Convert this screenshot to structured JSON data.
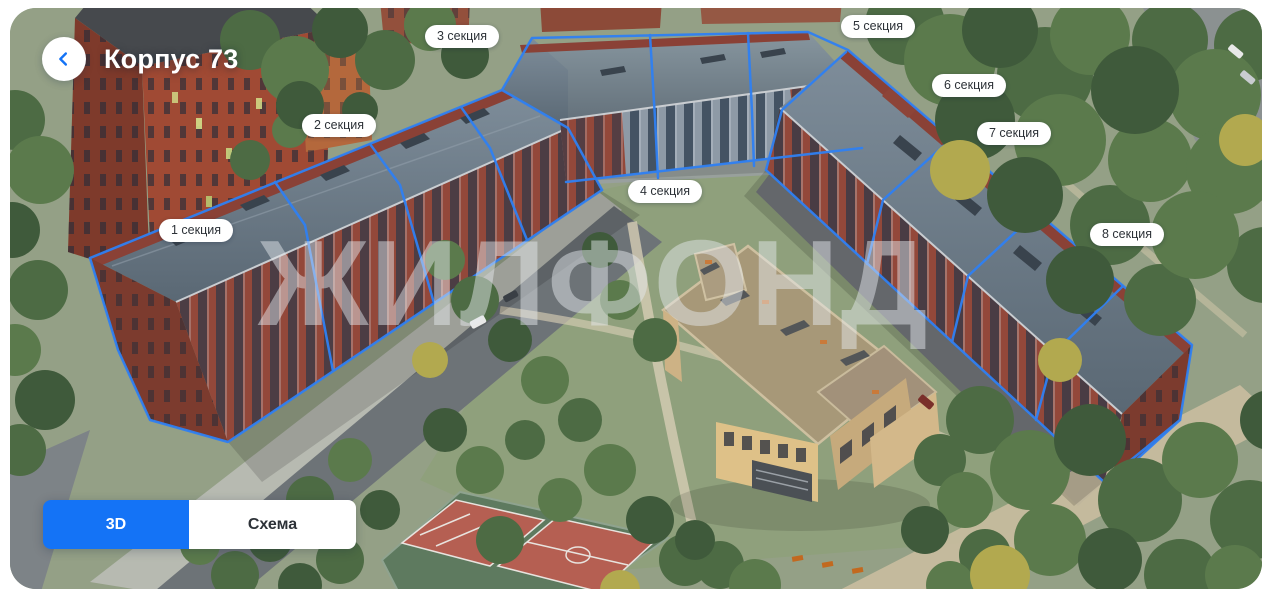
{
  "card": {
    "title": "Корпус 73"
  },
  "back_button": {
    "icon": "chevron-left"
  },
  "sections": [
    {
      "label": "1 секция"
    },
    {
      "label": "2 секция"
    },
    {
      "label": "3 секция"
    },
    {
      "label": "4 секция"
    },
    {
      "label": "5 секция"
    },
    {
      "label": "6 секция"
    },
    {
      "label": "7 секция"
    },
    {
      "label": "8 секция"
    }
  ],
  "watermark": "ЖИЛФОНД",
  "view_toggle": {
    "options": [
      {
        "label": "3D",
        "active": true
      },
      {
        "label": "Схема",
        "active": false
      }
    ]
  },
  "colors": {
    "accent_blue": "#1473f6",
    "outline_blue": "#2f80f3",
    "pill_background": "#ffffff",
    "pill_text": "#2d3238"
  }
}
